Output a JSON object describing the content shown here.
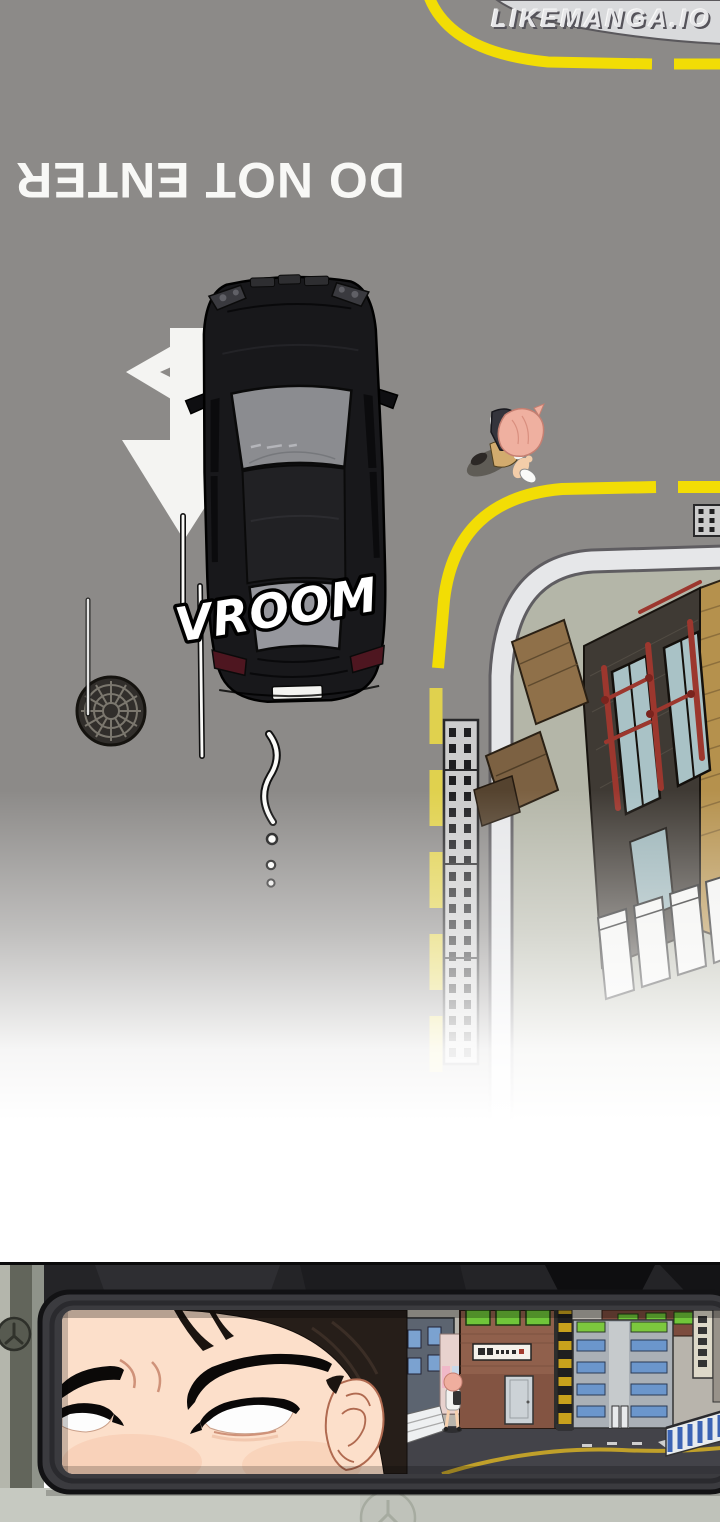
{
  "page": {
    "kind": "webtoon-comic-page",
    "width": 720,
    "height": 1522
  },
  "watermark": {
    "text": "LIKEMANGA.IO"
  },
  "top_panel": {
    "description": "overhead street view, black sedan driving the wrong way",
    "road_text": "DO NOT ENTER",
    "sfx_text": "VROOM"
  },
  "bottom_panel": {
    "description": "driver's narrowed eyes reflected in rear-view mirror, street behind"
  },
  "icons": {
    "wall_emblem": "circled-y-logo",
    "floor_emblem": "circled-y-logo",
    "manhole": "round-manhole-cover",
    "road_arrow": "straight-ahead-lane-arrow"
  },
  "colors": {
    "road": "#8c8a88",
    "sidewalk-light": "#d9dadc",
    "sidewalk-green": "#b4b6a8",
    "lane-yellow": "#f2dd05",
    "lane-yellow-faded": "#e0d14e",
    "marking-white": "#f4f4f2",
    "curb": "#e6e7e9",
    "car-body": "#18181b",
    "car-glass": "#8b8c90",
    "sfx-fill": "#ffffff",
    "sfx-stroke": "#000000",
    "mirror-frame": "#3b3b3f",
    "skin": "#fcdfca",
    "hair": "#261e19",
    "mirror-road": "#434349"
  }
}
